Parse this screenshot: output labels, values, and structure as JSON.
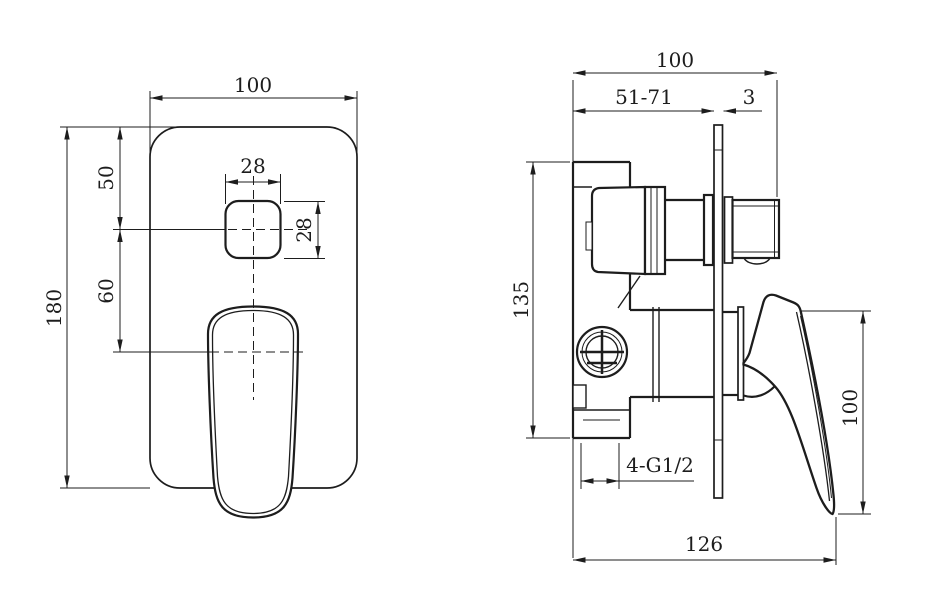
{
  "drawing": {
    "background": "#ffffff",
    "line_color": "#1d1d1d",
    "front_view": {
      "dim_width": "100",
      "dim_height": "180",
      "dim_top_to_button": "50",
      "dim_button_to_handle": "60",
      "dim_button_width": "28",
      "dim_button_height": "28"
    },
    "side_view": {
      "dim_depth": "100",
      "dim_installation_depth": "51-71",
      "dim_plate_thickness": "3",
      "dim_body_height": "135",
      "dim_handle_height": "100",
      "dim_total_depth": "126",
      "dim_connection_thread": "4-G1/2"
    }
  }
}
